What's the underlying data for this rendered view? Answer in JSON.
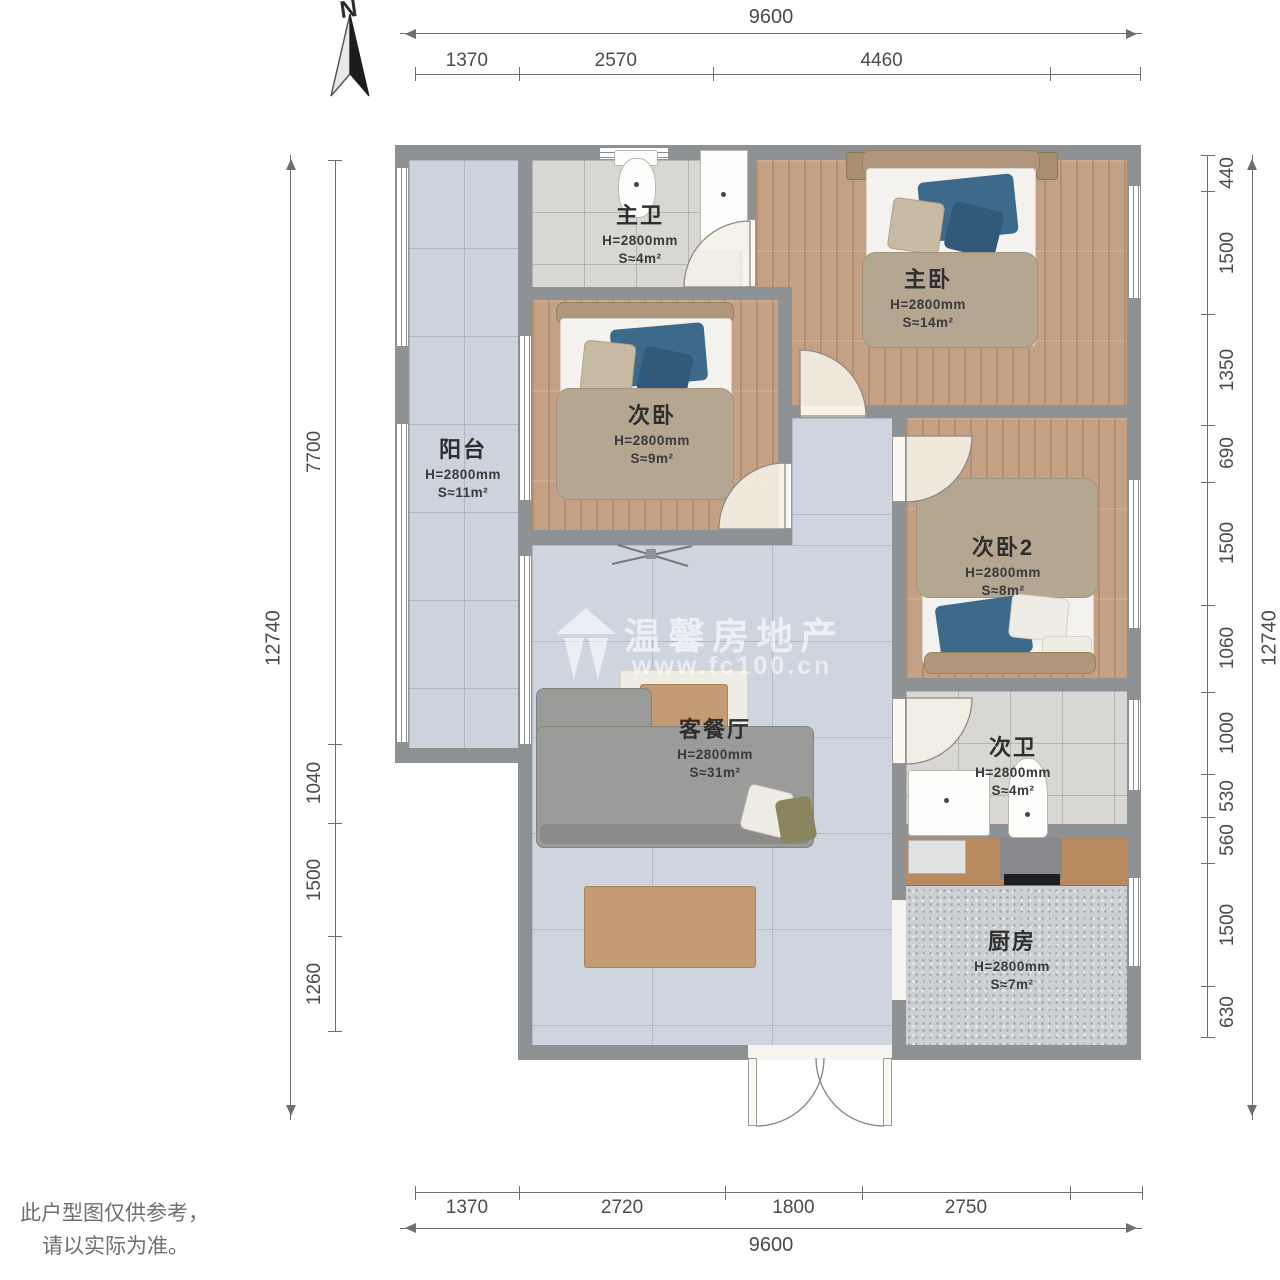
{
  "compass": {
    "label": "N"
  },
  "watermark": {
    "brand": "温馨房地产",
    "url": "www.fc100.cn"
  },
  "disclaimer": {
    "line1": "此户型图仅供参考，",
    "line2": "请以实际为准。"
  },
  "rooms": [
    {
      "id": "master-bath",
      "name": "主卫",
      "height": "H=2800mm",
      "area": "S≈4m²"
    },
    {
      "id": "master-bedroom",
      "name": "主卧",
      "height": "H=2800mm",
      "area": "S≈14m²"
    },
    {
      "id": "bedroom-2",
      "name": "次卧",
      "height": "H=2800mm",
      "area": "S≈9m²"
    },
    {
      "id": "balcony",
      "name": "阳台",
      "height": "H=2800mm",
      "area": "S≈11m²"
    },
    {
      "id": "bedroom-3",
      "name": "次卧2",
      "height": "H=2800mm",
      "area": "S≈8m²"
    },
    {
      "id": "living-dining",
      "name": "客餐厅",
      "height": "H=2800mm",
      "area": "S≈31m²"
    },
    {
      "id": "second-bath",
      "name": "次卫",
      "height": "H=2800mm",
      "area": "S≈4m²"
    },
    {
      "id": "kitchen",
      "name": "厨房",
      "height": "H=2800mm",
      "area": "S≈7m²"
    }
  ],
  "dimensions": {
    "top": {
      "total": "9600",
      "segments": [
        {
          "label": "1370",
          "mm": 1370
        },
        {
          "label": "2570",
          "mm": 2570
        },
        {
          "label": "4460",
          "mm": 4460
        },
        {
          "label": "",
          "mm": 1200
        }
      ]
    },
    "bottom": {
      "total": "9600",
      "segments": [
        {
          "label": "1370",
          "mm": 1370
        },
        {
          "label": "2720",
          "mm": 2720
        },
        {
          "label": "1800",
          "mm": 1800
        },
        {
          "label": "2750",
          "mm": 2750
        },
        {
          "label": "",
          "mm": 960
        }
      ]
    },
    "left": {
      "total": "12740",
      "segments": [
        {
          "label": "7700",
          "mm": 7700
        },
        {
          "label": "1040",
          "mm": 1040
        },
        {
          "label": "1500",
          "mm": 1500
        },
        {
          "label": "1260",
          "mm": 1260
        }
      ]
    },
    "right": {
      "total": "12740",
      "segments": [
        {
          "label": "440",
          "mm": 440
        },
        {
          "label": "1500",
          "mm": 1500
        },
        {
          "label": "1350",
          "mm": 1350
        },
        {
          "label": "690",
          "mm": 690
        },
        {
          "label": "1500",
          "mm": 1500
        },
        {
          "label": "1060",
          "mm": 1060
        },
        {
          "label": "1000",
          "mm": 1000
        },
        {
          "label": "530",
          "mm": 530
        },
        {
          "label": "560",
          "mm": 560
        },
        {
          "label": "1500",
          "mm": 1500
        },
        {
          "label": "630",
          "mm": 630
        }
      ]
    }
  }
}
